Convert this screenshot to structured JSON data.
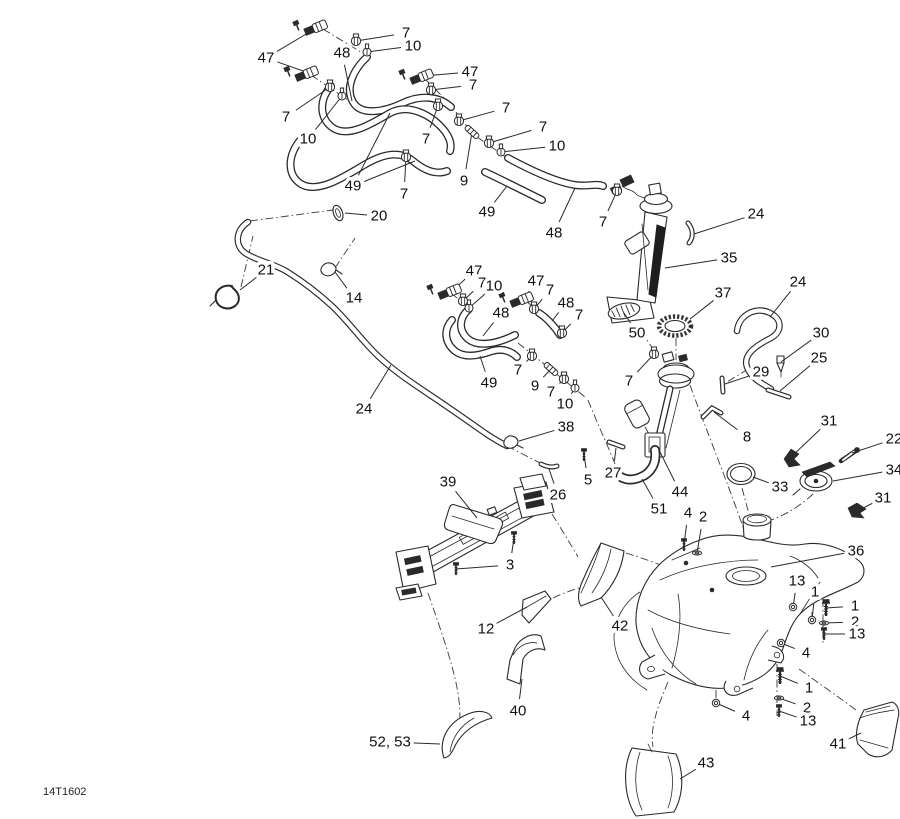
{
  "drawing": {
    "code": "14T1602",
    "type": "exploded-parts-diagram"
  },
  "colors": {
    "background": "#ffffff",
    "line": "#2a2a2a",
    "label": "#111111"
  },
  "callouts": [
    {
      "label": "47",
      "x": 266,
      "y": 58,
      "targets": [
        [
          318,
          27
        ],
        [
          309,
          73
        ]
      ],
      "marker": "fitting"
    },
    {
      "label": "7",
      "x": 406,
      "y": 33,
      "targets": [
        [
          356,
          41
        ]
      ],
      "marker": "clamp"
    },
    {
      "label": "10",
      "x": 413,
      "y": 46,
      "targets": [
        [
          367,
          52
        ]
      ],
      "marker": "pinch"
    },
    {
      "label": "48",
      "x": 342,
      "y": 53,
      "targets": [
        [
          352,
          101
        ]
      ],
      "marker": null
    },
    {
      "label": "7",
      "x": 286,
      "y": 117,
      "targets": [
        [
          330,
          87
        ]
      ],
      "marker": "clamp"
    },
    {
      "label": "10",
      "x": 308,
      "y": 139,
      "targets": [
        [
          342,
          96
        ]
      ],
      "marker": "pinch"
    },
    {
      "label": "47",
      "x": 470,
      "y": 72,
      "targets": [
        [
          424,
          76
        ]
      ],
      "marker": "fitting"
    },
    {
      "label": "7",
      "x": 473,
      "y": 85,
      "targets": [
        [
          431,
          90
        ]
      ],
      "marker": "clamp"
    },
    {
      "label": "7",
      "x": 506,
      "y": 108,
      "targets": [
        [
          459,
          121
        ]
      ],
      "marker": "clamp"
    },
    {
      "label": "7",
      "x": 543,
      "y": 127,
      "targets": [
        [
          489,
          143
        ]
      ],
      "marker": "clamp"
    },
    {
      "label": "10",
      "x": 557,
      "y": 146,
      "targets": [
        [
          501,
          152
        ]
      ],
      "marker": "pinch"
    },
    {
      "label": "7",
      "x": 426,
      "y": 139,
      "targets": [
        [
          438,
          106
        ]
      ],
      "marker": "clamp"
    },
    {
      "label": "9",
      "x": 464,
      "y": 181,
      "targets": [
        [
          472,
          132
        ]
      ],
      "marker": "tube"
    },
    {
      "label": "7",
      "x": 404,
      "y": 194,
      "targets": [
        [
          406,
          157
        ]
      ],
      "marker": "clamp"
    },
    {
      "label": "49",
      "x": 353,
      "y": 186,
      "targets": [
        [
          390,
          113
        ],
        [
          415,
          161
        ]
      ],
      "marker": null
    },
    {
      "label": "49",
      "x": 487,
      "y": 212,
      "targets": [
        [
          507,
          186
        ]
      ],
      "marker": null
    },
    {
      "label": "48",
      "x": 554,
      "y": 233,
      "targets": [
        [
          575,
          188
        ]
      ],
      "marker": null
    },
    {
      "label": "7",
      "x": 603,
      "y": 222,
      "targets": [
        [
          617,
          191
        ]
      ],
      "marker": "clamp"
    },
    {
      "label": "20",
      "x": 379,
      "y": 216,
      "targets": [
        [
          345,
          213
        ]
      ],
      "marker": null
    },
    {
      "label": "21",
      "x": 266,
      "y": 270,
      "targets": [
        [
          240,
          290
        ]
      ],
      "marker": null
    },
    {
      "label": "14",
      "x": 354,
      "y": 298,
      "targets": [
        [
          335,
          272
        ]
      ],
      "marker": null
    },
    {
      "label": "24",
      "x": 364,
      "y": 409,
      "targets": [
        [
          391,
          365
        ]
      ],
      "marker": null
    },
    {
      "label": "47",
      "x": 474,
      "y": 271,
      "targets": [
        [
          452,
          291
        ]
      ],
      "marker": "fitting"
    },
    {
      "label": "7",
      "x": 482,
      "y": 283,
      "targets": [
        [
          463,
          301
        ]
      ],
      "marker": "clamp"
    },
    {
      "label": "10",
      "x": 494,
      "y": 286,
      "targets": [
        [
          469,
          308
        ]
      ],
      "marker": "pinch"
    },
    {
      "label": "48",
      "x": 501,
      "y": 313,
      "targets": [
        [
          483,
          336
        ]
      ],
      "marker": null
    },
    {
      "label": "47",
      "x": 536,
      "y": 281,
      "targets": [
        [
          524,
          299
        ]
      ],
      "marker": "fitting"
    },
    {
      "label": "7",
      "x": 550,
      "y": 290,
      "targets": [
        [
          534,
          309
        ]
      ],
      "marker": "clamp"
    },
    {
      "label": "48",
      "x": 566,
      "y": 303,
      "targets": [
        [
          552,
          321
        ]
      ],
      "marker": null
    },
    {
      "label": "7",
      "x": 579,
      "y": 315,
      "targets": [
        [
          562,
          333
        ]
      ],
      "marker": "clamp"
    },
    {
      "label": "49",
      "x": 489,
      "y": 383,
      "targets": [
        [
          480,
          356
        ]
      ],
      "marker": null
    },
    {
      "label": "7",
      "x": 518,
      "y": 370,
      "targets": [
        [
          532,
          356
        ]
      ],
      "marker": "clamp"
    },
    {
      "label": "9",
      "x": 535,
      "y": 386,
      "targets": [
        [
          551,
          369
        ]
      ],
      "marker": "tube"
    },
    {
      "label": "7",
      "x": 551,
      "y": 392,
      "targets": [
        [
          564,
          379
        ]
      ],
      "marker": "clamp"
    },
    {
      "label": "10",
      "x": 565,
      "y": 404,
      "targets": [
        [
          575,
          388
        ]
      ],
      "marker": "pinch"
    },
    {
      "label": "38",
      "x": 566,
      "y": 427,
      "targets": [
        [
          519,
          441
        ]
      ],
      "marker": null
    },
    {
      "label": "26",
      "x": 558,
      "y": 495,
      "targets": [
        [
          549,
          469
        ]
      ],
      "marker": null
    },
    {
      "label": "5",
      "x": 588,
      "y": 480,
      "targets": [
        [
          584,
          455
        ]
      ],
      "marker": "screw"
    },
    {
      "label": "27",
      "x": 613,
      "y": 473,
      "targets": [
        [
          616,
          448
        ]
      ],
      "marker": null
    },
    {
      "label": "51",
      "x": 659,
      "y": 509,
      "targets": [
        [
          642,
          479
        ]
      ],
      "marker": null
    },
    {
      "label": "44",
      "x": 680,
      "y": 492,
      "targets": [
        [
          660,
          452
        ]
      ],
      "marker": null
    },
    {
      "label": "7",
      "x": 629,
      "y": 381,
      "targets": [
        [
          654,
          354
        ]
      ],
      "marker": "clamp"
    },
    {
      "label": "24",
      "x": 756,
      "y": 214,
      "targets": [
        [
          694,
          234
        ]
      ],
      "marker": null
    },
    {
      "label": "35",
      "x": 729,
      "y": 258,
      "targets": [
        [
          665,
          268
        ]
      ],
      "marker": null
    },
    {
      "label": "37",
      "x": 723,
      "y": 293,
      "targets": [
        [
          690,
          319
        ]
      ],
      "marker": null
    },
    {
      "label": "50",
      "x": 637,
      "y": 333,
      "targets": [
        [
          624,
          313
        ]
      ],
      "marker": null
    },
    {
      "label": "24",
      "x": 798,
      "y": 282,
      "targets": [
        [
          770,
          317
        ]
      ],
      "marker": null
    },
    {
      "label": "30",
      "x": 821,
      "y": 333,
      "targets": [
        [
          781,
          362
        ]
      ],
      "marker": null
    },
    {
      "label": "25",
      "x": 819,
      "y": 358,
      "targets": [
        [
          780,
          391
        ]
      ],
      "marker": null
    },
    {
      "label": "29",
      "x": 761,
      "y": 372,
      "targets": [
        [
          725,
          384
        ]
      ],
      "marker": null
    },
    {
      "label": "8",
      "x": 747,
      "y": 437,
      "targets": [
        [
          714,
          412
        ]
      ],
      "marker": null
    },
    {
      "label": "31",
      "x": 829,
      "y": 421,
      "targets": [
        [
          792,
          456
        ]
      ],
      "marker": null
    },
    {
      "label": "22",
      "x": 894,
      "y": 439,
      "targets": [
        [
          852,
          453
        ]
      ],
      "marker": null
    },
    {
      "label": "34",
      "x": 894,
      "y": 470,
      "targets": [
        [
          833,
          481
        ]
      ],
      "marker": null
    },
    {
      "label": "31",
      "x": 883,
      "y": 498,
      "targets": [
        [
          857,
          511
        ]
      ],
      "marker": null
    },
    {
      "label": "33",
      "x": 780,
      "y": 487,
      "targets": [
        [
          753,
          477
        ]
      ],
      "marker": null
    },
    {
      "label": "4",
      "x": 688,
      "y": 513,
      "targets": [
        [
          684,
          545
        ]
      ],
      "marker": "screw"
    },
    {
      "label": "2",
      "x": 703,
      "y": 517,
      "targets": [
        [
          697,
          553
        ]
      ],
      "marker": "washer"
    },
    {
      "label": "36",
      "x": 856,
      "y": 551,
      "targets": [
        [
          771,
          567
        ]
      ],
      "marker": null
    },
    {
      "label": "13",
      "x": 797,
      "y": 581,
      "targets": [
        [
          793,
          607
        ]
      ],
      "marker": "nut"
    },
    {
      "label": "1",
      "x": 815,
      "y": 592,
      "targets": [
        [
          812,
          620
        ]
      ],
      "marker": "nut"
    },
    {
      "label": "1",
      "x": 855,
      "y": 606,
      "targets": [
        [
          826,
          608
        ]
      ],
      "marker": "bolt"
    },
    {
      "label": "2",
      "x": 855,
      "y": 622,
      "targets": [
        [
          824,
          623
        ]
      ],
      "marker": "washer"
    },
    {
      "label": "13",
      "x": 857,
      "y": 634,
      "targets": [
        [
          824,
          634
        ]
      ],
      "marker": "screw"
    },
    {
      "label": "4",
      "x": 806,
      "y": 653,
      "targets": [
        [
          781,
          643
        ]
      ],
      "marker": "nut"
    },
    {
      "label": "4",
      "x": 746,
      "y": 716,
      "targets": [
        [
          716,
          703
        ]
      ],
      "marker": "nut"
    },
    {
      "label": "1",
      "x": 809,
      "y": 688,
      "targets": [
        [
          780,
          676
        ]
      ],
      "marker": "bolt"
    },
    {
      "label": "2",
      "x": 807,
      "y": 708,
      "targets": [
        [
          779,
          698
        ]
      ],
      "marker": "washer"
    },
    {
      "label": "13",
      "x": 808,
      "y": 721,
      "targets": [
        [
          779,
          711
        ]
      ],
      "marker": "screw"
    },
    {
      "label": "41",
      "x": 838,
      "y": 744,
      "targets": [
        [
          861,
          733
        ]
      ],
      "marker": null
    },
    {
      "label": "43",
      "x": 706,
      "y": 763,
      "targets": [
        [
          680,
          779
        ]
      ],
      "marker": null
    },
    {
      "label": "39",
      "x": 448,
      "y": 482,
      "targets": [
        [
          477,
          518
        ]
      ],
      "marker": null
    },
    {
      "label": "3",
      "x": 510,
      "y": 565,
      "targets": [
        [
          456,
          569
        ],
        [
          514,
          538
        ]
      ],
      "marker": "screw"
    },
    {
      "label": "12",
      "x": 486,
      "y": 629,
      "targets": [
        [
          527,
          607
        ]
      ],
      "marker": null
    },
    {
      "label": "42",
      "x": 620,
      "y": 626,
      "targets": [
        [
          601,
          597
        ]
      ],
      "marker": null
    },
    {
      "label": "40",
      "x": 518,
      "y": 711,
      "targets": [
        [
          522,
          679
        ]
      ],
      "marker": null
    },
    {
      "label": "52, 53",
      "x": 390,
      "y": 742,
      "targets": [
        [
          440,
          744
        ]
      ],
      "marker": null
    }
  ]
}
